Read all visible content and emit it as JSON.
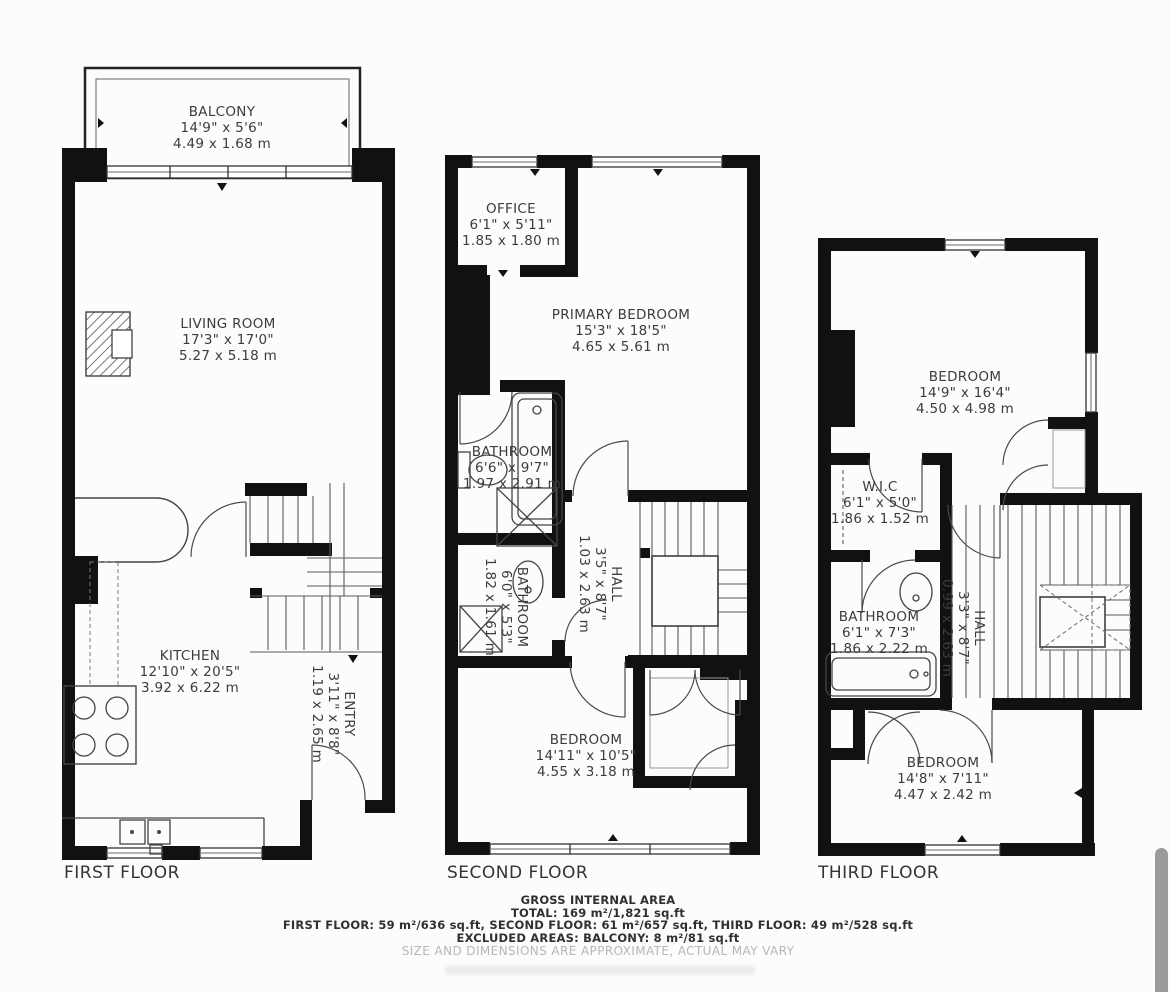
{
  "floors": [
    {
      "title": "FIRST FLOOR",
      "rooms": [
        {
          "name": "BALCONY",
          "imperial": "14'9\" x 5'6\"",
          "metric": "4.49 x 1.68 m"
        },
        {
          "name": "LIVING ROOM",
          "imperial": "17'3\" x 17'0\"",
          "metric": "5.27 x 5.18 m"
        },
        {
          "name": "KITCHEN",
          "imperial": "12'10\" x 20'5\"",
          "metric": "3.92 x 6.22 m"
        },
        {
          "name": "ENTRY",
          "imperial": "3'11\" x 8'8\"",
          "metric": "1.19 x 2.65 m"
        }
      ]
    },
    {
      "title": "SECOND FLOOR",
      "rooms": [
        {
          "name": "OFFICE",
          "imperial": "6'1\" x 5'11\"",
          "metric": "1.85 x 1.80 m"
        },
        {
          "name": "PRIMARY BEDROOM",
          "imperial": "15'3\" x 18'5\"",
          "metric": "4.65 x 5.61 m"
        },
        {
          "name": "BATHROOM",
          "imperial": "6'6\" x 9'7\"",
          "metric": "1.97 x 2.91 m"
        },
        {
          "name": "BATHROOM",
          "imperial": "6'0\" x 5'3\"",
          "metric": "1.82 x 1.61 m"
        },
        {
          "name": "HALL",
          "imperial": "3'5\" x 8'7\"",
          "metric": "1.03 x 2.63 m"
        },
        {
          "name": "BEDROOM",
          "imperial": "14'11\" x 10'5\"",
          "metric": "4.55 x 3.18 m"
        }
      ]
    },
    {
      "title": "THIRD FLOOR",
      "rooms": [
        {
          "name": "BEDROOM",
          "imperial": "14'9\" x 16'4\"",
          "metric": "4.50 x 4.98 m"
        },
        {
          "name": "W.I.C",
          "imperial": "6'1\" x 5'0\"",
          "metric": "1.86 x 1.52 m"
        },
        {
          "name": "BATHROOM",
          "imperial": "6'1\" x 7'3\"",
          "metric": "1.86 x 2.22 m"
        },
        {
          "name": "HALL",
          "imperial": "3'3\" x 8'7\"",
          "metric": "0.99 x 2.63 m"
        },
        {
          "name": "BEDROOM",
          "imperial": "14'8\" x 7'11\"",
          "metric": "4.47 x 2.42 m"
        }
      ]
    }
  ],
  "footer": {
    "heading": "GROSS INTERNAL AREA",
    "total": "TOTAL: 169 m²/1,821 sq.ft",
    "floors_line": "FIRST FLOOR: 59 m²/636 sq.ft, SECOND FLOOR: 61 m²/657 sq.ft, THIRD FLOOR: 49 m²/528 sq.ft",
    "excluded": "EXCLUDED AREAS: BALCONY: 8 m²/81 sq.ft",
    "disclaimer": "SIZE AND DIMENSIONS ARE APPROXIMATE, ACTUAL MAY VARY"
  },
  "colors": {
    "wall": "#111111",
    "line": "#4a4a4a",
    "text": "#3c3c3c",
    "muted": "#b7b7b7"
  }
}
